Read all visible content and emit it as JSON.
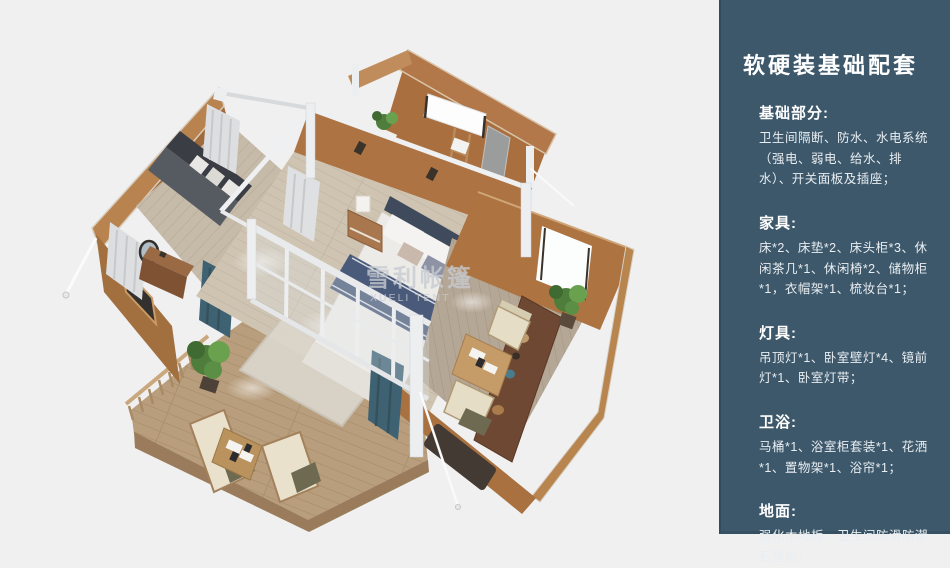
{
  "page": {
    "background": "#f0f0f1"
  },
  "sidebar": {
    "background": "#3d586b",
    "title": "软硬装基础配套",
    "sections": [
      {
        "heading": "基础部分:",
        "body": "卫生间隔断、防水、水电系统（强电、弱电、给水、排水）、开关面板及插座；"
      },
      {
        "heading": "家具:",
        "body": "床*2、床垫*2、床头柜*3、休闲茶几*1、休闲椅*2、储物柜*1，衣帽架*1、梳妆台*1；"
      },
      {
        "heading": "灯具:",
        "body": "吊顶灯*1、卧室壁灯*4、镜前灯*1、卧室灯带；"
      },
      {
        "heading": "卫浴:",
        "body": "马桶*1、浴室柜套装*1、花洒*1、置物架*1、浴帘*1；"
      },
      {
        "heading": "地面:",
        "body": "强化木地板、卫生间防滑防潮石塑板；"
      }
    ]
  },
  "watermark": {
    "cn": "雪利帐篷",
    "en": "XUELI TENT"
  },
  "illustration": {
    "description": "isometric-3d-floor-plan-of-glamping-tent-suite",
    "colors": {
      "wall": "#ad7342",
      "wall_light": "#c28b59",
      "frame_white": "#eceef0",
      "floor_wood": "#cfc4b2",
      "deck_wood": "#b89e7d",
      "curtain_teal": "#3f6273",
      "bed_navy": "#4a5a7a",
      "plant_green": "#4e7d3c"
    }
  }
}
